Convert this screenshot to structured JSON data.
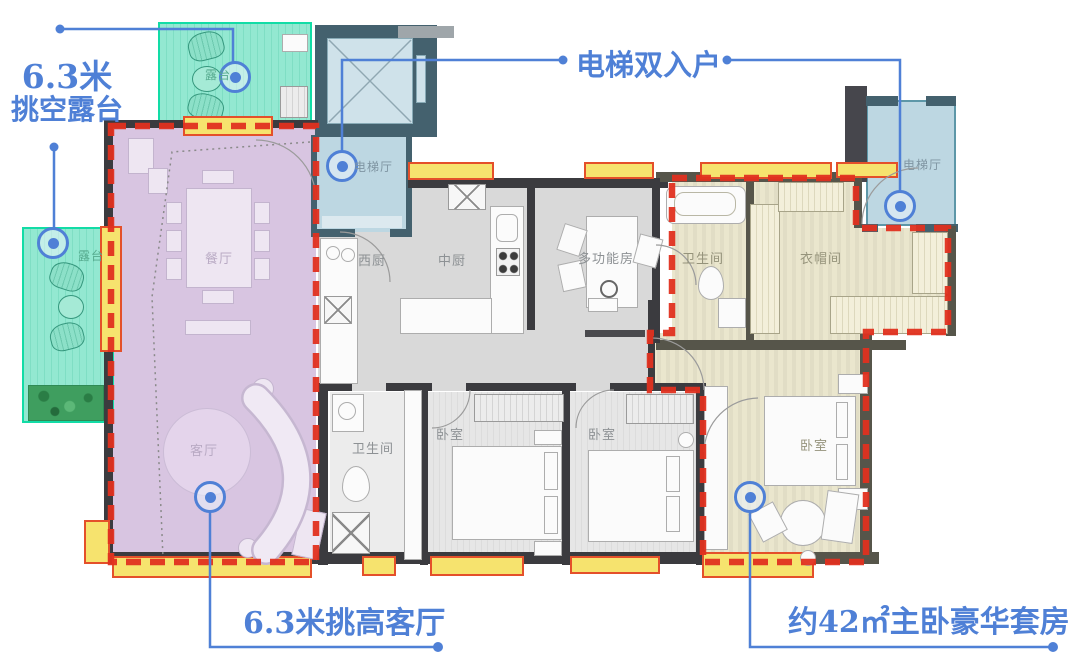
{
  "plan": {
    "rooms": {
      "terrace_top": {
        "label": "露台"
      },
      "terrace_left": {
        "label": "露台"
      },
      "elevator_hall_left": {
        "label": "电梯厅"
      },
      "elevator_hall_right": {
        "label": "电梯厅"
      },
      "dining": {
        "label": "餐厅"
      },
      "west_kitchen": {
        "label": "西厨"
      },
      "chinese_kitchen": {
        "label": "中厨"
      },
      "multi_function_room": {
        "label": "多功能房"
      },
      "master_bathroom": {
        "label": "卫生间"
      },
      "cloakroom": {
        "label": "衣帽间"
      },
      "living_room": {
        "label": "客厅"
      },
      "bathroom": {
        "label": "卫生间"
      },
      "bedroom_1": {
        "label": "卧室"
      },
      "bedroom_2": {
        "label": "卧室"
      },
      "master_bedroom": {
        "label": "卧室"
      }
    },
    "callouts": {
      "void_terrace": {
        "line1": "6.3米",
        "line2": "挑空露台"
      },
      "double_elevator": {
        "text": "电梯双入户"
      },
      "high_living": {
        "text": "6.3米挑高客厅"
      },
      "master_suite": {
        "text": "约42㎡主卧豪华套房"
      }
    },
    "colors": {
      "callout_blue": "#4f80d6",
      "zone_red": "#e0301f",
      "terrace_teal_fill": "#8fe7cf",
      "terrace_teal_border": "#12dca6",
      "elevator_blue_fill": "#bdd7e2",
      "elevator_wall_slate": "#44616e",
      "living_zone_purple": "#d8c5e1",
      "master_suite_beige": "#eae6cd",
      "window_yellow": "#f6e36e",
      "window_frame_orange": "#e4502a",
      "wall_dark": "#3b3b3f",
      "floor_gray": "#d9d9d9"
    }
  }
}
